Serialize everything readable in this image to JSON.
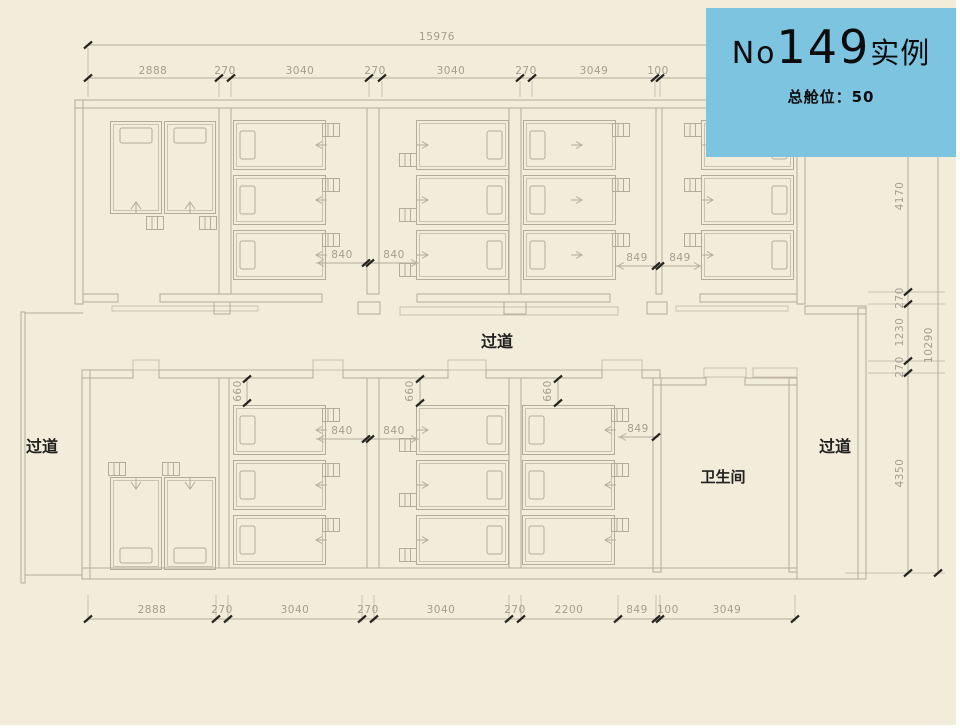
{
  "card": {
    "prefix": "No",
    "number": "149",
    "suffix": "实例",
    "subtitle": "总舱位：50"
  },
  "rooms": {
    "corridor_center": "过道",
    "corridor_left": "过道",
    "corridor_right": "过道",
    "bathroom": "卫生间"
  },
  "dims": {
    "overall_top": "15976",
    "top": [
      "2888",
      "270",
      "3040",
      "270",
      "3040",
      "270",
      "3049",
      "100"
    ],
    "bottom": [
      "2888",
      "270",
      "3040",
      "270",
      "3040",
      "270",
      "2200",
      "849",
      "100",
      "3049"
    ],
    "right": [
      "4170",
      "270",
      "1230",
      "270",
      "4350"
    ],
    "right_overall": "10290",
    "upper_left_pair": [
      "840",
      "840"
    ],
    "upper_right_pair": [
      "849",
      "849"
    ],
    "lower_left_pair": [
      "840",
      "840"
    ],
    "lower_right": "849",
    "setbacks": [
      "660",
      "660",
      "660"
    ]
  },
  "colors": {
    "background": "#f2ecdb",
    "card": "#7dc4e1",
    "line": "#b4ab9b",
    "dim_text": "#a69d8e",
    "dark_text": "#21211f"
  }
}
